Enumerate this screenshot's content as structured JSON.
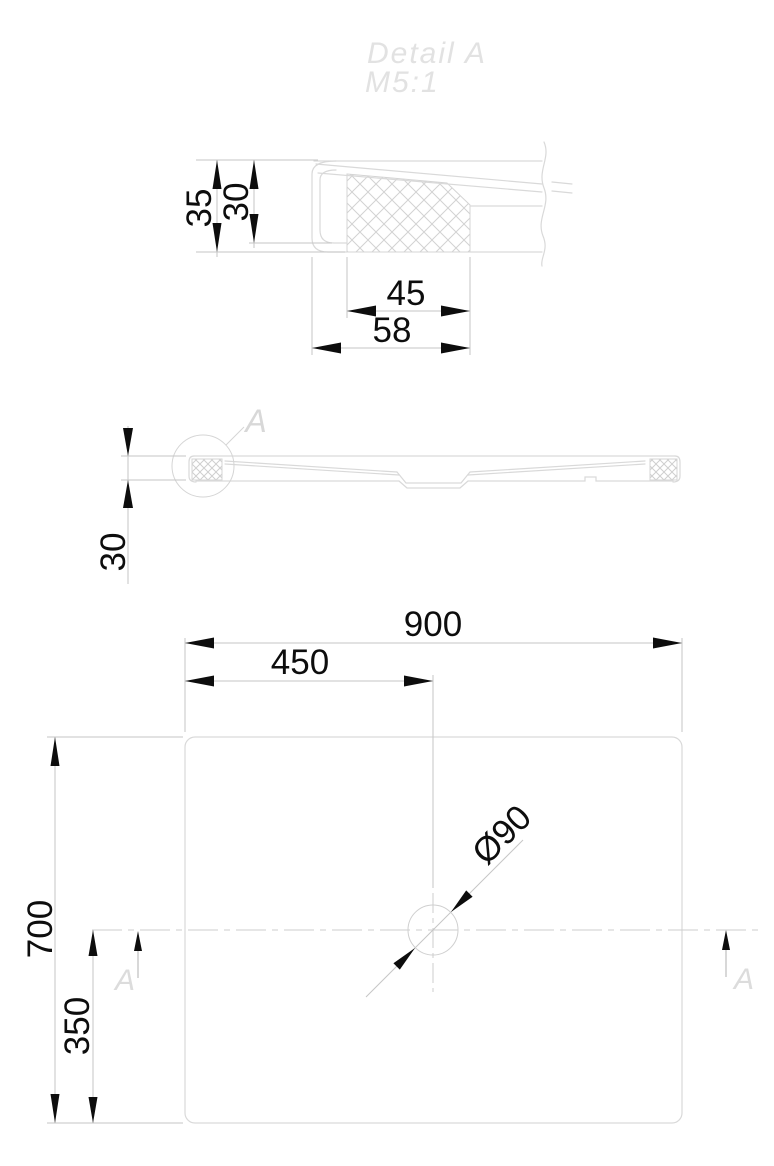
{
  "title": {
    "name": "Detail A",
    "scale": "M5:1"
  },
  "detail_view": {
    "dim_total_height": "35",
    "dim_core_height": "30",
    "dim_core_width": "45",
    "dim_total_width": "58"
  },
  "side_view": {
    "dim_height": "30",
    "detail_callout": "A"
  },
  "plan_view": {
    "dim_width": "900",
    "dim_width_center": "450",
    "dim_depth": "700",
    "dim_depth_center": "350",
    "dim_drain_diameter": "Ø90",
    "section_marker_left": "A",
    "section_marker_right": "A"
  },
  "colors": {
    "drawing_line": "#d9d9d9",
    "dimension_line": "#c6c6c6",
    "dimension_text": "#0d0d0d",
    "callout_text": "#d8d8d8",
    "title_text": "#e2e2e2",
    "background": "#ffffff"
  }
}
